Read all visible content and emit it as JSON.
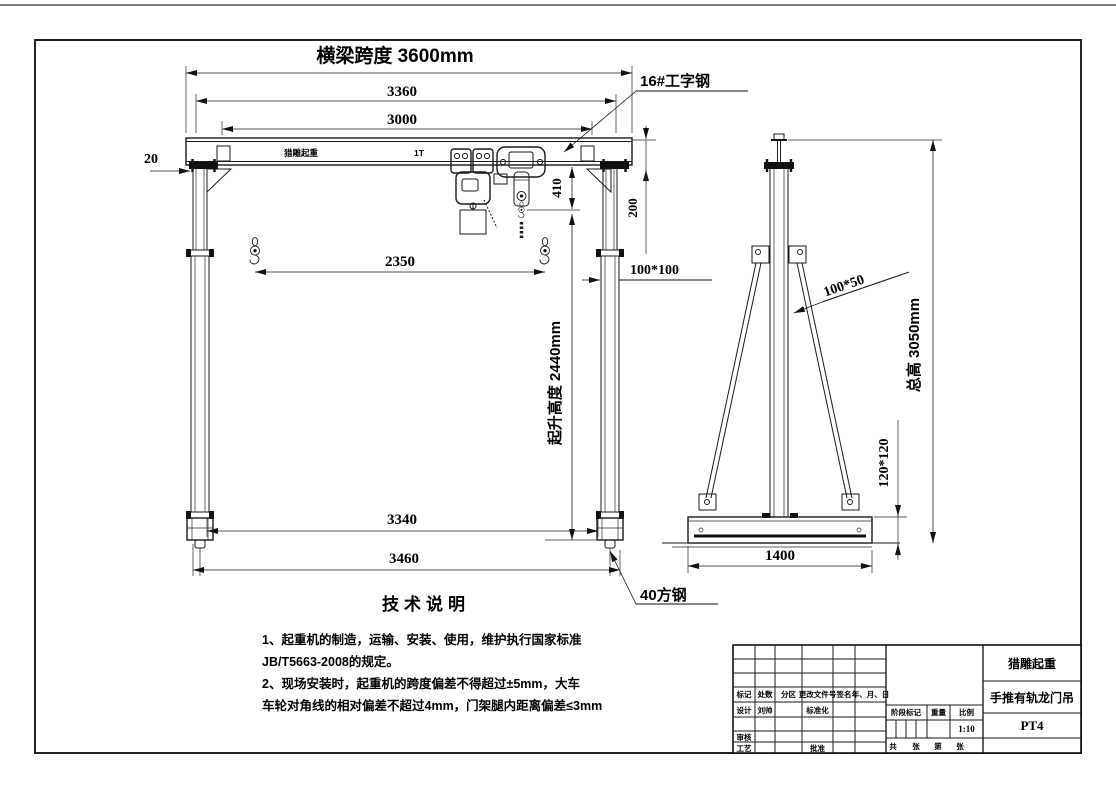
{
  "front_view": {
    "beam_brand": "猎雕起重",
    "beam_capacity": "1T",
    "span_dim": "横梁跨度 3600mm",
    "dim_3360": "3360",
    "dim_3000": "3000",
    "dim_20": "20",
    "beam_callout": "16#工字钢",
    "dim_410": "410",
    "dim_200": "200",
    "dim_2350": "2350",
    "leg_section": "100*100",
    "lift_height_dim": "起升高度 2440mm",
    "dim_3340": "3340",
    "dim_3460": "3460",
    "wheel_callout": "40方钢"
  },
  "side_view": {
    "total_height_dim": "总高 3050mm",
    "brace_section": "100*50",
    "base_section": "120*120",
    "dim_1400": "1400"
  },
  "notes": {
    "title": "技术说明",
    "lines": [
      "1、起重机的制造，运输、安装、使用，维护执行国家标准",
      "JB/T5663-2008的规定。",
      "2、现场安装时，起重机的跨度偏差不得超过±5mm，大车",
      "车轮对角线的相对偏差不超过4mm，门架腿内距离偏差≤3mm"
    ]
  },
  "title_block": {
    "company": "猎雕起重",
    "product_name": "手推有轨龙门吊",
    "drawing_no": "PT4",
    "scale_value": "1:10",
    "col_mark": "标记",
    "col_count": "处数",
    "col_zone": "分区",
    "col_change_doc": "更改文件号",
    "col_sign": "签名",
    "col_date": "年、月、日",
    "row_design": "设计",
    "designer_name": "刘帅",
    "row_standardization": "标准化",
    "row_review": "审核",
    "row_process": "工艺",
    "row_approve": "批准",
    "stage_mark": "阶段标记",
    "weight": "重量",
    "scale_label": "比例",
    "sheet_total_label": "共",
    "sheet_unit1": "张",
    "sheet_no_label": "第",
    "sheet_unit2": "张"
  }
}
